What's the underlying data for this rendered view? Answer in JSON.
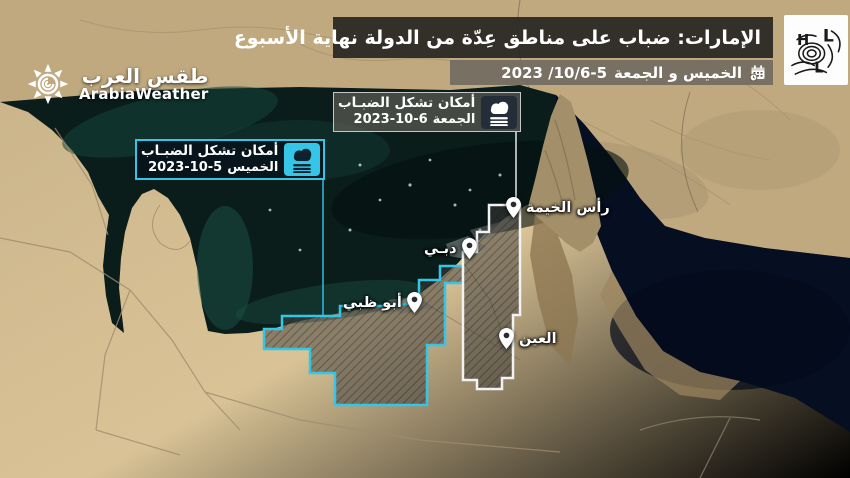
{
  "header": {
    "title": "الإمارات: ضباب على مناطق عِدّة من الدولة نهاية الأسبوع",
    "date_words": "الخميس و الجمعة",
    "date_numbers": "2023 /10/6-5"
  },
  "brand": {
    "arabic": "طقس العرب",
    "english": "ArabiaWeather"
  },
  "logo_letters": {
    "h": "H",
    "l1": "L",
    "l2": "L"
  },
  "legends": {
    "friday": {
      "title": "أمكان تشكل الضبـاب",
      "day": "الجمعة",
      "date": "2023-10-6"
    },
    "thursday": {
      "title": "أمكان تشكل الضبـاب",
      "day": "الخميس",
      "date": "2023-10-5"
    }
  },
  "cities": {
    "ras_al_khaimah": "رأس الخيمة",
    "dubai": "دبـي",
    "abu_dhabi": "أبو ظبي",
    "al_ain": "العين"
  },
  "colors": {
    "thursday_accent": "#35c5e6",
    "friday_accent": "#f2f2f2",
    "header_bg": "#2b2926",
    "water_gulf": "#0a1d1b",
    "water_oman": "#060f22",
    "sand": "#d9c396"
  }
}
